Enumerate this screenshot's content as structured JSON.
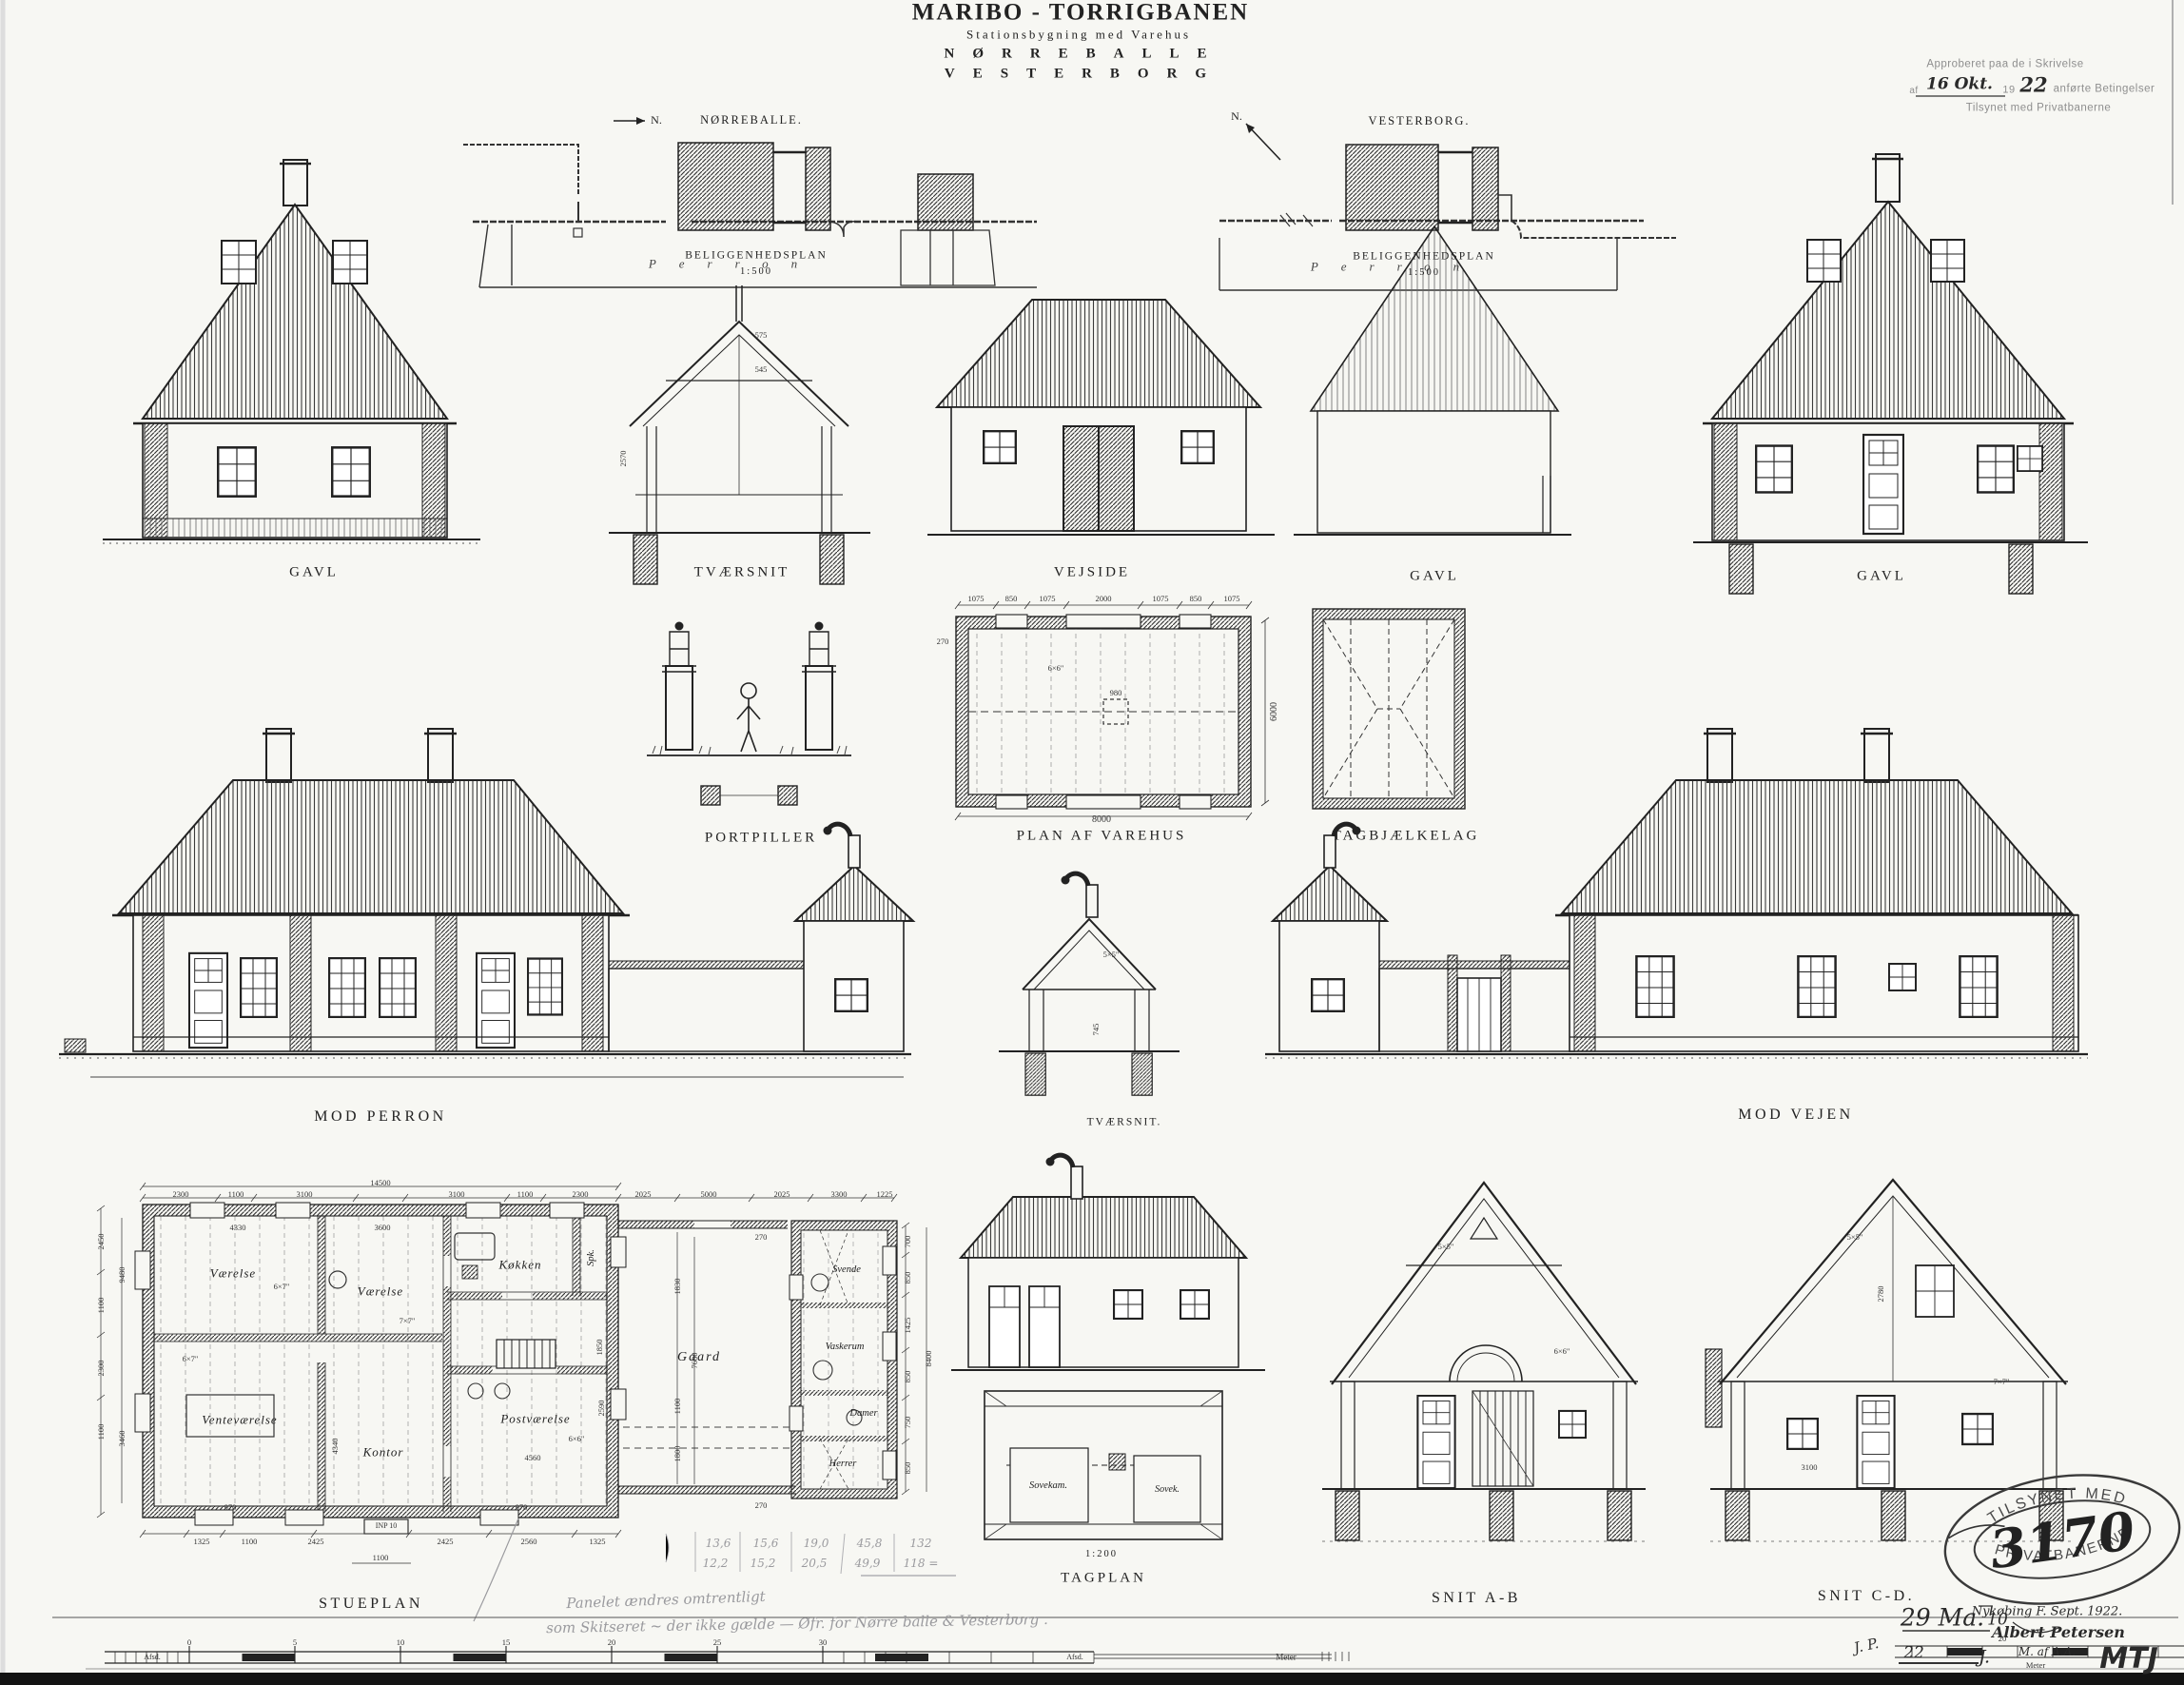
{
  "title": {
    "line1": "MARIBO - TORRIGBANEN",
    "line2": "Stationsbygning med Varehus",
    "line3": "NØRREBALLE",
    "line4": "VESTERBORG"
  },
  "approval": {
    "line1": "Approberet paa de i Skrivelse",
    "prefix": "af",
    "hand_date": "16 Okt.",
    "year": "19",
    "hand_year": "22",
    "rest": "anførte Betingelser",
    "line3": "Tilsynet med Privatbanerne"
  },
  "site_left": {
    "north": "N.",
    "name": "NØRREBALLE.",
    "platform": "Perron",
    "caption": "BELIGGENHEDSPLAN",
    "scale": "1:500"
  },
  "site_right": {
    "north": "N.",
    "name": "VESTERBORG.",
    "platform": "Perron",
    "caption": "BELIGGENHEDSPLAN",
    "scale": "1:500"
  },
  "row1": {
    "gavl1": "GAVL",
    "tvaersnit": "TVÆRSNIT",
    "vejside": "VEJSIDE",
    "gavl2": "GAVL",
    "gavl3": "GAVL",
    "dim_575": "575",
    "dim_545": "545",
    "dim_2570": "2570"
  },
  "row2": {
    "portpiller": "PORTPILLER",
    "varehus_plan": "PLAN AF VAREHUS",
    "tagbjaelkelag": "TAGBJÆLKELAG",
    "mod_perron": "MOD PERRON",
    "tvaersnit_small": "TVÆRSNIT.",
    "mod_vejen": "MOD VEJEN",
    "ts_dim_5x5": "5×5\"",
    "ts_dim_745": "745"
  },
  "varehus_plan": {
    "dims_top": [
      "1075",
      "850",
      "1075",
      "2000",
      "1075",
      "850",
      "1075"
    ],
    "dim_left": "270",
    "dim_right": "6000",
    "dim_bottom": "8000",
    "post": "980",
    "beam": "6×6\""
  },
  "stueplan": {
    "label": "STUEPLAN",
    "rooms": {
      "vaerelse1": "Værelse",
      "vaerelse2": "Værelse",
      "koekken": "Køkken",
      "spk": "Spk.",
      "ventevaerelse": "Venteværelse",
      "kontor": "Kontor",
      "postvaerelse": "Postværelse",
      "gaard": "Gaard",
      "svende": "Svende",
      "vaskerum": "Vaskerum",
      "damer": "Damer",
      "herrer": "Herrer"
    },
    "dims_top": [
      "2300",
      "1100",
      "3100",
      "3100",
      "1100",
      "2300"
    ],
    "dim_total": "14500",
    "dims_wing_top": [
      "2025",
      "5000",
      "2025",
      "3300",
      "1225"
    ],
    "dims_left": [
      "2450",
      "1100",
      "2300",
      "1100"
    ],
    "dims_left_inner": [
      "9480",
      "3460"
    ],
    "dims_right": [
      "700",
      "850",
      "1425",
      "850",
      "750",
      "850"
    ],
    "dim_right_total": "8400",
    "dims_court": [
      "1830",
      "7680",
      "1100",
      "1800"
    ],
    "dim_270a": "270",
    "dim_270b": "270",
    "dims_inner": [
      "4330",
      "3600",
      "4340",
      "1850",
      "2590",
      "4560",
      "970",
      "970"
    ],
    "beam_marks": [
      "6×7\"",
      "6×7\"",
      "7×7\"",
      "6×6\""
    ],
    "dims_bottom": [
      "1325",
      "1100",
      "2425",
      "2425",
      "2560",
      "1325"
    ],
    "beam_label": "INP 10",
    "dim_1100b": "1100"
  },
  "tagplan": {
    "scale": "1:200",
    "label": "TAGPLAN",
    "room_left": "Sovekam.",
    "room_right": "Sovek."
  },
  "snit_ab": {
    "label": "SNIT A-B",
    "dim_5x5": "5×5\"",
    "dim_6x6": "6×6\""
  },
  "snit_cd": {
    "label": "SNIT C-D.",
    "dim_5x5": "5×5\"",
    "dim_7x7": "7×7\"",
    "dim_2780": "2780",
    "dim_3100": "3100"
  },
  "stamp": {
    "arc_top": "TILSYNET MED",
    "number": "3170",
    "arc_bottom": "PRIVATBANERNE"
  },
  "signature": {
    "place_date": "Nykøbing F. Sept. 1922.",
    "name": "Albert Petersen",
    "org": "M. af A.A.",
    "hand_29": "29 Ma.",
    "hand_10": "10",
    "hand_22": "22",
    "hand_J": "J.",
    "initials": "J. P."
  },
  "pencil": {
    "row1": [
      "13,6",
      "15,6",
      "19,0",
      "45,8",
      "132"
    ],
    "row2": [
      "12,2",
      "15,2",
      "20,5",
      "49,9",
      "118 ="
    ],
    "note1": "Panelet ændres omtrentligt",
    "note2": "som Skitseret ~ der ikke gælde — Øfr. for Nørre balle & Vesterborg ."
  },
  "scalebar": {
    "numbers": [
      "0",
      "5",
      "10",
      "15",
      "20",
      "25",
      "30"
    ],
    "afsd_left": "Afsd.",
    "afsd_right": "Afsd.",
    "unit": "Meter",
    "right_num": "20",
    "right_unit": "Meter"
  },
  "corner": {
    "mtj": "MTJ"
  }
}
